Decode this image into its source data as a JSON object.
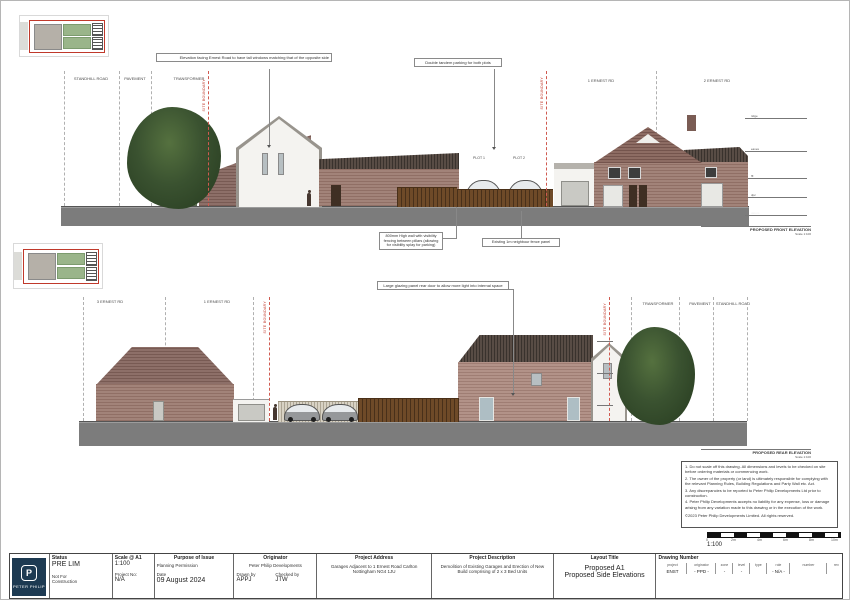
{
  "colors": {
    "brand_navy": "#1d3a52",
    "boundary_red": "#c0392b",
    "ground_grey": "#7c7c7c",
    "brick": "#a28379",
    "roof": "#584c45",
    "tree_green": "#3a5230",
    "fence_brown": "#6e4a28"
  },
  "front": {
    "title": "PROPOSED FRONT ELEVATION",
    "scale": "Scale 1:100",
    "callout_windows": "Elevation facing Ernest Road to have tall windows matching that of the opposite side",
    "callout_parking": "Double tandem parking for both plots",
    "callout_wall": "800mm High wall with visibility fencing between pillars (allowing for visibility splay for parking)",
    "callout_fence": "Existing 1m neighbour fence panel",
    "labels": {
      "road": "STANDHILL ROAD",
      "pavement": "PAVEMENT",
      "transformer": "TRANSFORMER",
      "boundary_left": "SITE BOUNDARY",
      "boundary_right": "SITE BOUNDARY",
      "plot1": "PLOT 1",
      "plot2": "PLOT 2",
      "house1": "1 ERNEST RD",
      "house2": "2 ERNEST RD"
    },
    "levels": [
      "ridge",
      "eaves",
      "ffl",
      "dpc",
      "datum"
    ]
  },
  "rear": {
    "title": "PROPOSED REAR ELEVATION",
    "scale": "Scale 1:100",
    "callout_door": "Large glazing panel rear door to allow more light into internal space",
    "labels": {
      "house3": "3 ERNEST RD",
      "house1": "1 ERNEST RD",
      "boundary_left": "SITE BOUNDARY",
      "boundary_right": "SITE BOUNDARY",
      "transformer": "TRANSFORMER",
      "pavement": "PAVEMENT",
      "road": "STANDHILL ROAD"
    }
  },
  "notes": {
    "lines": [
      "1. Do not scale off this drawing. All dimensions and levels to be checked on site before ordering materials or commencing work.",
      "2. The owner of the property (or land) is ultimately responsible for complying with the relevant Planning Rules, Building Regulations and Party Wall etc. Act.",
      "3. Any discrepancies to be reported to Peter Philip Developments Ltd prior to construction.",
      "4. Peter Philip Developments accepts no liability for  any expense, loss or damage arising from any variation made to this drawing or in the execution of the work."
    ],
    "copyright": "©2023 Peter Philip Developments Limited. All rights reserved."
  },
  "scalebar": {
    "ratio": "1:100",
    "ticks": [
      "0",
      "2m",
      "4m",
      "6m",
      "8m",
      "10m"
    ]
  },
  "titleblock": {
    "logo": {
      "brand": "PETER PHILIP",
      "monogram": "P"
    },
    "status": {
      "header": "Status",
      "value": "PRE LIM",
      "sub1": "Not For",
      "sub2": "Construction"
    },
    "scale": {
      "header": "Scale @ A1",
      "value": "1:100",
      "project_no_label": "Project No:",
      "project_no": "N/A"
    },
    "purpose": {
      "header": "Purpose of Issue",
      "value": "Planning Permission",
      "date_label": "Date",
      "date": "09 August 2024"
    },
    "originator": {
      "header": "Originator",
      "value": "Peter Philip Developments",
      "drawn_label": "Drawn by",
      "drawn": "APPJ",
      "checked_label": "Checked by",
      "checked": "JTW"
    },
    "address": {
      "header": "Project Address",
      "value": "Garages Adjacent to 1 Ernest Road Carlton Nottingham  NG4 1JU"
    },
    "description": {
      "header": "Project Description",
      "value": "Demolition of Existing Garages and Erection of New Build comprising of 2 x 3 Bed Units"
    },
    "layout": {
      "header": "Layout Title",
      "line1": "Proposed A1",
      "line2": "Proposed Side Elevations"
    },
    "drawing_number": {
      "header": "Drawing Number",
      "cols": [
        "project",
        "originator",
        "zone",
        "level",
        "type",
        "role",
        "number",
        "rev"
      ],
      "vals": [
        "ENST",
        "- PPD -",
        "-",
        "-",
        "",
        "- N/A -",
        "",
        ""
      ]
    }
  }
}
